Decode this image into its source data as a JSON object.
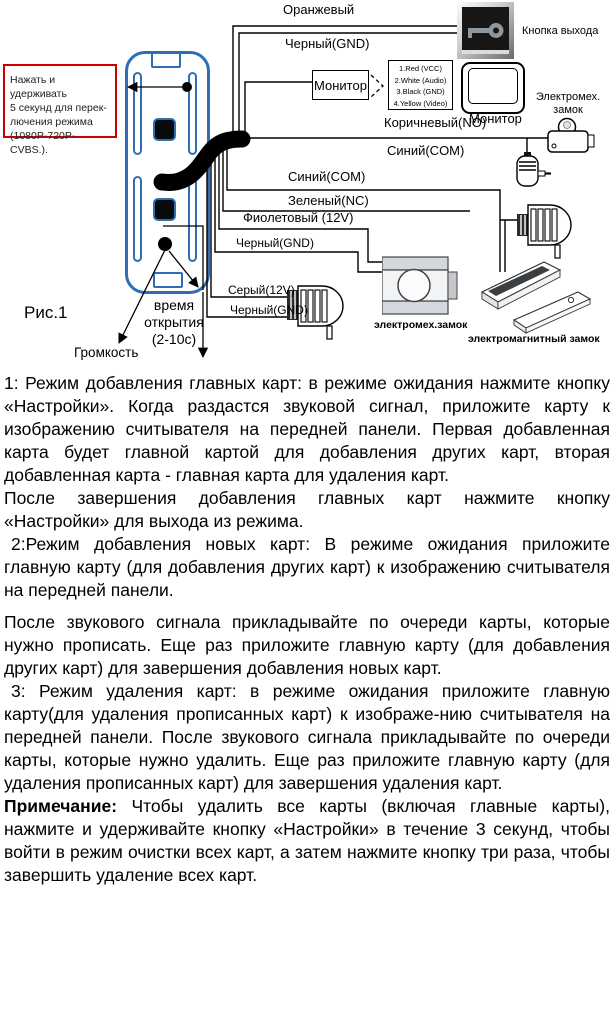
{
  "figure": {
    "caption": "Рис.1",
    "callout_text": "Нажать и удерживать\n5 секунд для перек-\nлючения режима\n(1080P-720P-CVBS.).",
    "volume_label": "Громкость",
    "open_time_label": "время\nоткрытия\n(2-10с)",
    "wires": {
      "orange": "Оранжевый",
      "black_exit": "Черный(GND)",
      "brown": "Коричневый(NO)",
      "blue_com_1": "Синий(COM)",
      "blue_com_2": "Синий(COM)",
      "green_nc": "Зеленый(NC)",
      "violet_12v": "Фиолетовый (12V)",
      "black_gnd_mid": "Черный(GND)",
      "gray_12v": "Серый(12V)",
      "black_gnd_low": "Черный(GND)"
    },
    "devices": {
      "exit_button": "Кнопка выхода",
      "monitor_block": "Монитор",
      "monitor_screen": "Монитор",
      "rca_pins": [
        "1.Red (VCC)",
        "2.White (Audio)",
        "3.Black (GND)",
        "4.Yellow (Video)"
      ],
      "electromech_lock": "Электромех.\nзамок",
      "electromech_lock_small": "электромех.замок",
      "electromagnetic_lock": "электромагнитный замок"
    }
  },
  "instructions": {
    "p1": "1: Режим добавления главных карт: в режиме ожидания нажмите кнопку «Настройки». Когда раздастся звуковой сигнал, приложите карту к изображению считывателя на передней панели. Первая добавленная карта будет главной картой для добавления других карт, вторая добавленная карта - главная карта для удаления карт.",
    "p2": "После завершения добавления главных карт нажмите кнопку «Настройки» для выхода из режима.",
    "p3": "2:Режим добавления новых карт: В режиме ожидания приложите главную карту (для добавления других карт) к изображению считывателя на передней панели.",
    "p4": "После звукового сигнала прикладывайте по очереди карты, которые нужно прописать. Еще раз приложите главную карту (для добавления других карт) для завершения добавления новых карт.",
    "p5": "3: Режим удаления карт: в режиме ожидания приложите главную карту(для удаления прописанных карт) к изображе-нию считывателя на передней панели. После звукового сигнала прикладывайте по очереди карты, которые нужно удалить. Еще раз приложите главную карту (для удаления прописанных карт) для завершения удаления карт.",
    "note_label": "Примечание:",
    "note_text": "Чтобы удалить все карты (включая главные карты), нажмите и удерживайте кнопку «Настройки» в течение 3 секунд, чтобы войти в режим очистки всех карт, а затем нажмите кнопку три раза, чтобы завершить удаление всех карт."
  }
}
